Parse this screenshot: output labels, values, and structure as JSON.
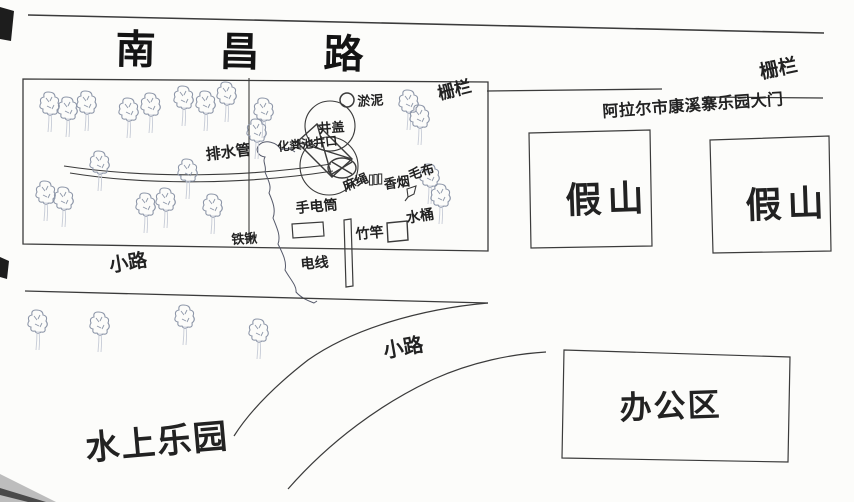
{
  "map": {
    "road": [
      "南",
      "昌",
      "路"
    ],
    "labels": {
      "fence_left": "栅栏",
      "fence_right": "栅栏",
      "gate": "阿拉尔市康溪寨乐园大门",
      "rockery_1": "假山",
      "rockery_2": "假山",
      "office_area": "办公区",
      "water_park": "水上乐园",
      "path_top": "小路",
      "path_bottom": "小路",
      "drain_pipe": "排水管",
      "septic_opening": "化粪池井口",
      "manhole_cover": "井盖",
      "silt": "淤泥",
      "rope": "麻绳",
      "cigarette": "香烟",
      "cloth": "毛布",
      "flashlight": "手电筒",
      "bamboo_pole": "竹竿",
      "bucket": "水桶",
      "shovel": "铁锹",
      "wire": "电线"
    },
    "colors": {
      "ink": "#3b3b3b",
      "tree": "#8e97a9",
      "paper": "#fcfcfa"
    }
  }
}
